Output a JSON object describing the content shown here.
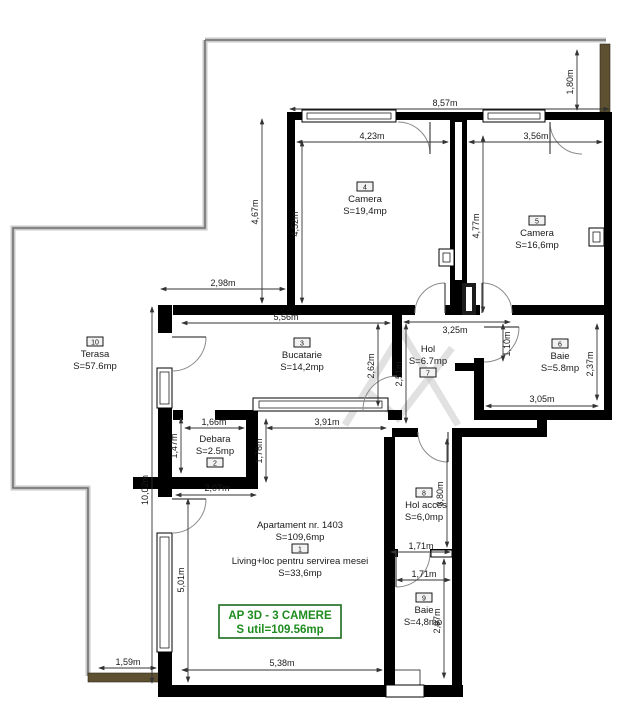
{
  "plan": {
    "apartment_header": "Apartament nr. 1403",
    "apartment_area": "S=109,6mp",
    "title_box": {
      "line1": "AP 3D - 3 CAMERE",
      "line2": "S util=109.56mp"
    }
  },
  "rooms": {
    "living": {
      "number": "1",
      "name": "Living+loc pentru servirea mesei",
      "area": "S=33,6mp"
    },
    "debara": {
      "number": "2",
      "name": "Debara",
      "area": "S=2.5mp"
    },
    "bucatarie": {
      "number": "3",
      "name": "Bucatarie",
      "area": "S=14,2mp"
    },
    "camera4": {
      "number": "4",
      "name": "Camera",
      "area": "S=19,4mp"
    },
    "camera5": {
      "number": "5",
      "name": "Camera",
      "area": "S=16,6mp"
    },
    "baie6": {
      "number": "6",
      "name": "Baie",
      "area": "S=5.8mp"
    },
    "hol7": {
      "number": "7",
      "name": "Hol",
      "area": "S=6.7mp"
    },
    "holacces": {
      "number": "8",
      "name": "Hol acces",
      "area": "S=6,0mp"
    },
    "baie9": {
      "number": "9",
      "name": "Baie",
      "area": "S=4,8mp"
    },
    "terasa": {
      "number": "10",
      "name": "Terasa",
      "area": "S=57.6mp"
    }
  },
  "dims": {
    "top_width": "8,57m",
    "terrace_top_height": "1,80m",
    "camera4_width": "4,23m",
    "camera5_width": "3,56m",
    "terrace_left_height": "4,67m",
    "camera4_height": "4,52m",
    "camera5_height": "4,77m",
    "kitchen_offset": "2,98m",
    "kitchen_width": "5,56m",
    "hol_width": "3,25m",
    "baie6_door_offset": "1,10m",
    "baie6_height": "2,37m",
    "baie6_width": "3,05m",
    "kitchen_height": "2,62m",
    "hol_height": "2,51m",
    "debara_width": "1,66m",
    "debara_height": "1,47m",
    "debara_wall_height": "1,76m",
    "kitchen_opening": "3,91m",
    "debara_bottom_width": "2,07m",
    "left_total_height": "10,02m",
    "living_left_height": "5,01m",
    "holacces_height": "3,80m",
    "holacces_width": "1,71m",
    "baie9_width": "1,71m",
    "baie9_height": "2,97m",
    "terrace_bottom_width": "1,59m",
    "living_width": "5,38m"
  },
  "colors": {
    "accent_green": "#1e8c1e",
    "wall_black": "#000000",
    "wood_brown": "#5e5132",
    "terrace_gray": "#c9c9c9"
  }
}
